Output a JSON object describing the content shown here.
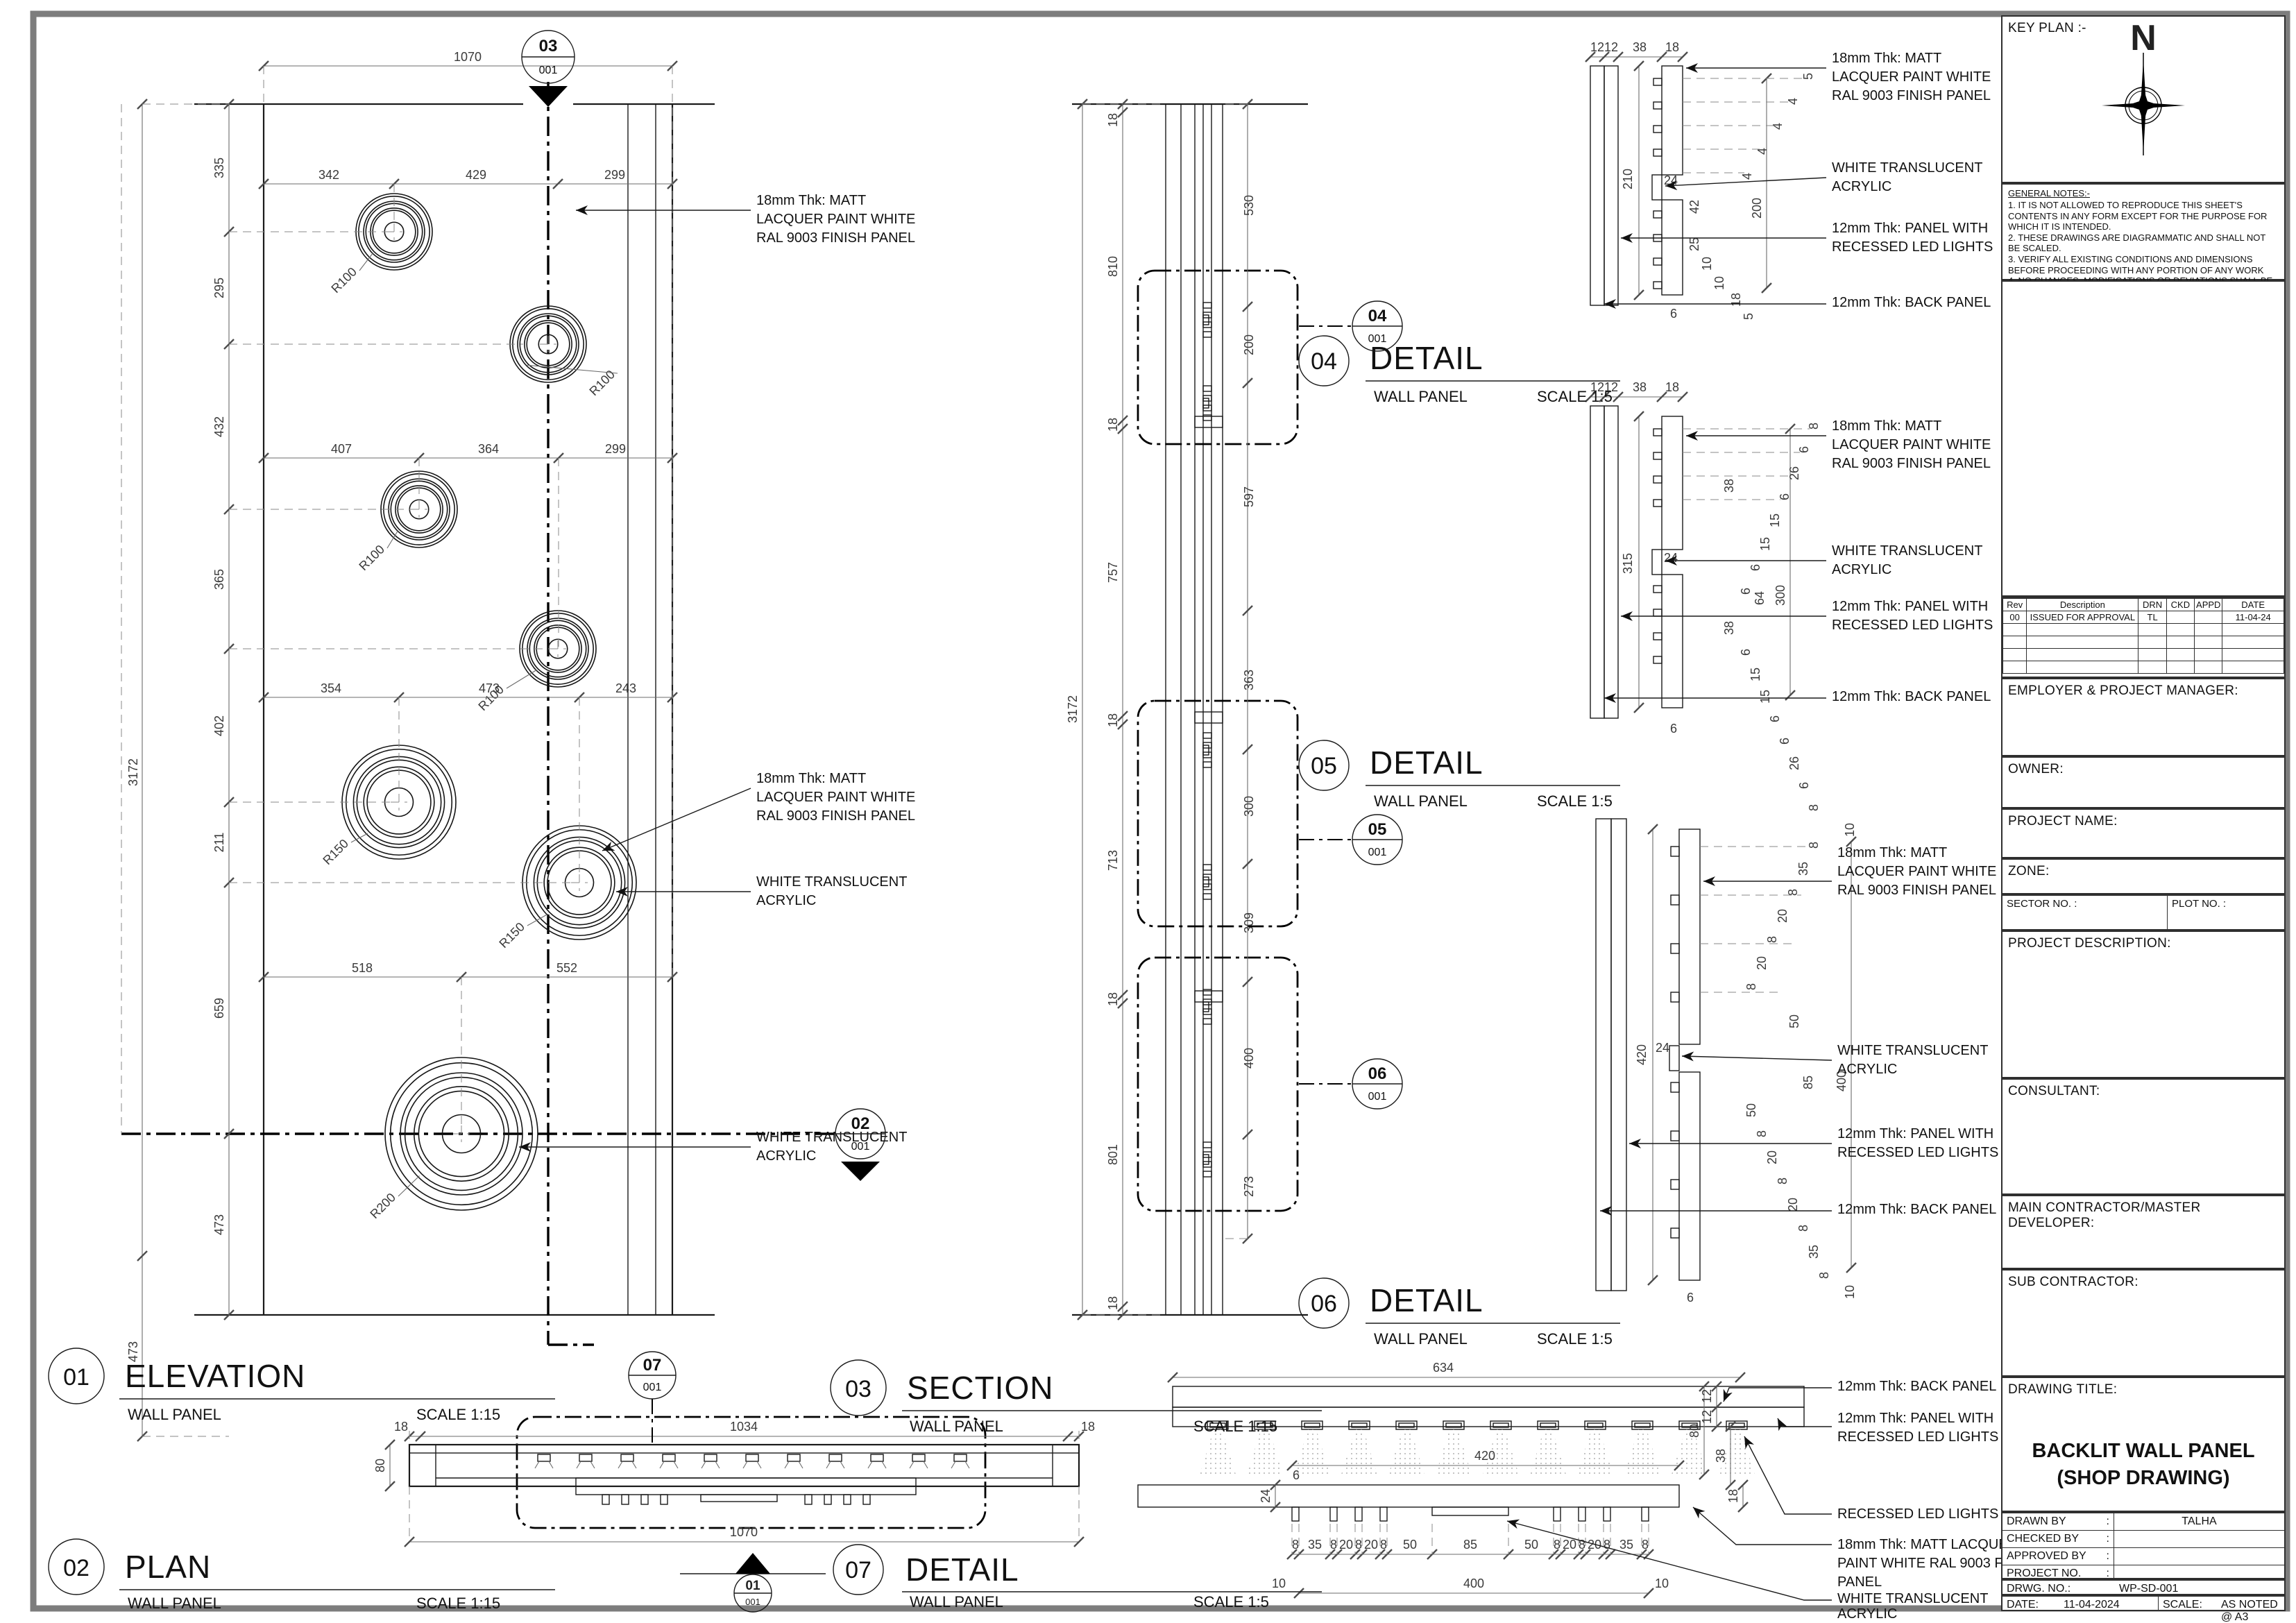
{
  "doc": {
    "key_plan": "KEY PLAN :-",
    "north": "N",
    "notes_title": "GENERAL NOTES:-",
    "notes": [
      "1. IT IS NOT ALLOWED TO REPRODUCE THIS SHEET'S  CONTENTS IN ANY FORM EXCEPT FOR THE PURPOSE  FOR WHICH IT IS INTENDED.",
      "2. THESE DRAWINGS ARE DIAGRAMMATIC AND SHALL NOT BE SCALED.",
      "3. VERIFY ALL EXISTING CONDITIONS AND DIMENSIONS  BEFORE PROCEEDING WITH ANY PORTION  OF ANY WORK",
      "4. NO CHANGES, MODIFICATIONS OR DEVIATIONS SHALL BE MADE FROM THE DRAWINGS OR SPECIFICATIONS WITHOUT  SECURING WRITTEN PERMISSION."
    ],
    "rev": {
      "headers": [
        "Rev",
        "Description",
        "DRN",
        "CKD",
        "APPD",
        "DATE"
      ],
      "row": [
        "00",
        "ISSUED FOR APPROVAL",
        "TL",
        "",
        "",
        "11-04-24"
      ]
    },
    "employer": "EMPLOYER & PROJECT MANAGER:",
    "owner": "OWNER:",
    "project_name": "PROJECT NAME:",
    "zone": "ZONE:",
    "sector": "SECTOR NO. :",
    "plot": "PLOT NO. :",
    "project_description": "PROJECT DESCRIPTION:",
    "consultant": "CONSULTANT:",
    "main_contractor": "MAIN CONTRACTOR/MASTER DEVELOPER:",
    "sub_contractor": "SUB CONTRACTOR:",
    "drawing_title_label": "DRAWING TITLE:",
    "drawing_title1": "BACKLIT WALL PANEL",
    "drawing_title2": "(SHOP DRAWING)",
    "drawn_by_label": "DRAWN BY",
    "drawn_by": "TALHA",
    "checked_by_label": "CHECKED BY",
    "checked_by": "",
    "approved_by_label": "APPROVED BY",
    "approved_by": "",
    "project_no_label": "PROJECT NO.",
    "project_no": "",
    "colon": ":",
    "drwg_no_label": "DRWG. NO.:",
    "drwg_no": "WP-SD-001",
    "date_label": "DATE:",
    "date": "11-04-2024",
    "scale_label": "SCALE:",
    "scale": "AS NOTED @ A3"
  },
  "ann": {
    "matt3": [
      "18mm Thk: MATT",
      "LACQUER PAINT WHITE",
      "RAL 9003 FINISH PANEL"
    ],
    "matt3b": [
      "18mm Thk: MATT LACQUER",
      "PAINT WHITE RAL 9003 FINISH",
      "PANEL"
    ],
    "acrylic": [
      "WHITE TRANSLUCENT",
      "ACRYLIC"
    ],
    "led": [
      "12mm Thk: PANEL WITH",
      "RECESSED LED LIGHTS"
    ],
    "back": "12mm Thk: BACK PANEL",
    "recessed": "RECESSED LED LIGHTS"
  },
  "v": {
    "el": {
      "num": "01",
      "name": "ELEVATION",
      "sub": "WALL PANEL",
      "scale": "SCALE 1:15",
      "outer_total": "3172",
      "outer_bottom": "473",
      "top_total": "1070",
      "vchain": [
        "335",
        "295",
        "432",
        "365",
        "402",
        "211",
        "659",
        "473"
      ],
      "h1": [
        "342",
        "429",
        "299"
      ],
      "h2": [
        "407",
        "364",
        "299"
      ],
      "h3": [
        "354",
        "473",
        "243"
      ],
      "h4": [
        "518",
        "552"
      ],
      "r": [
        "R100",
        "R100",
        "R100",
        "R100",
        "R150",
        "R150",
        "R200"
      ],
      "mtop": {
        "n": "03",
        "s": "001"
      },
      "mright": {
        "n": "02",
        "s": "001"
      }
    },
    "pl": {
      "num": "02",
      "name": "PLAN",
      "sub": "WALL PANEL",
      "scale": "SCALE 1:15",
      "d18l": "18",
      "d1034": "1034",
      "d18r": "18",
      "d80": "80",
      "d1070": "1070",
      "mtop": {
        "n": "07",
        "s": "001"
      },
      "mbot": {
        "n": "01",
        "s": "001"
      }
    },
    "se": {
      "num": "03",
      "name": "SECTION",
      "sub": "WALL PANEL",
      "scale": "SCALE 1:15",
      "total": "3172",
      "lchain": [
        "18",
        "810",
        "18",
        "757",
        "18",
        "713",
        "18",
        "801",
        "18"
      ],
      "rchain": [
        "530",
        "200",
        "597",
        "363",
        "300",
        "309",
        "400",
        "273"
      ],
      "m": [
        {
          "n": "04",
          "s": "001"
        },
        {
          "n": "05",
          "s": "001"
        },
        {
          "n": "06",
          "s": "001"
        }
      ]
    },
    "d4": {
      "num": "04",
      "name": "DETAIL",
      "sub": "WALL PANEL",
      "scale": "SCALE 1:5",
      "top": [
        "12",
        "12",
        "38",
        "18"
      ],
      "casA": [
        "5",
        "4",
        "4",
        "4",
        "4"
      ],
      "d210": "210",
      "d24": "24",
      "d42": "42",
      "d200": "200",
      "casB": [
        "25",
        "10",
        "10",
        "18",
        "5"
      ],
      "d6": "6"
    },
    "d5": {
      "num": "05",
      "name": "DETAIL",
      "sub": "WALL PANEL",
      "scale": "SCALE 1:5",
      "top": [
        "12",
        "12",
        "38",
        "18"
      ],
      "casA": [
        "8",
        "6",
        "26",
        "6",
        "15",
        "15",
        "6",
        "6"
      ],
      "d38a": "38",
      "d315": "315",
      "d24": "24",
      "d64": "64",
      "d300": "300",
      "d38b": "38",
      "casB": [
        "6",
        "15",
        "15",
        "6",
        "6",
        "26",
        "6",
        "8"
      ],
      "d6": "6"
    },
    "d6": {
      "num": "06",
      "name": "DETAIL",
      "sub": "WALL PANEL",
      "scale": "SCALE 1:5",
      "d10t": "10",
      "casA": [
        "8",
        "35",
        "8",
        "20",
        "8",
        "20",
        "8"
      ],
      "d50a": "50",
      "d24": "24",
      "d420": "420",
      "d85": "85",
      "d400": "400",
      "casB": [
        "50",
        "8",
        "20",
        "8",
        "20",
        "8",
        "35",
        "8"
      ],
      "d10b": "10",
      "d6": "6"
    },
    "d7": {
      "num": "07",
      "name": "DETAIL",
      "sub": "WALL PANEL",
      "scale": "SCALE 1:5",
      "d634": "634",
      "d420": "420",
      "right": [
        "80",
        "38",
        "12",
        "12",
        "18"
      ],
      "d24": "24",
      "d6": "6",
      "chain": [
        "8",
        "35",
        "8",
        "20",
        "8",
        "20",
        "8",
        "50",
        "85",
        "50",
        "8",
        "20",
        "8",
        "20",
        "8",
        "35",
        "8"
      ],
      "d10l": "10",
      "d10r": "10",
      "d400": "400"
    }
  }
}
